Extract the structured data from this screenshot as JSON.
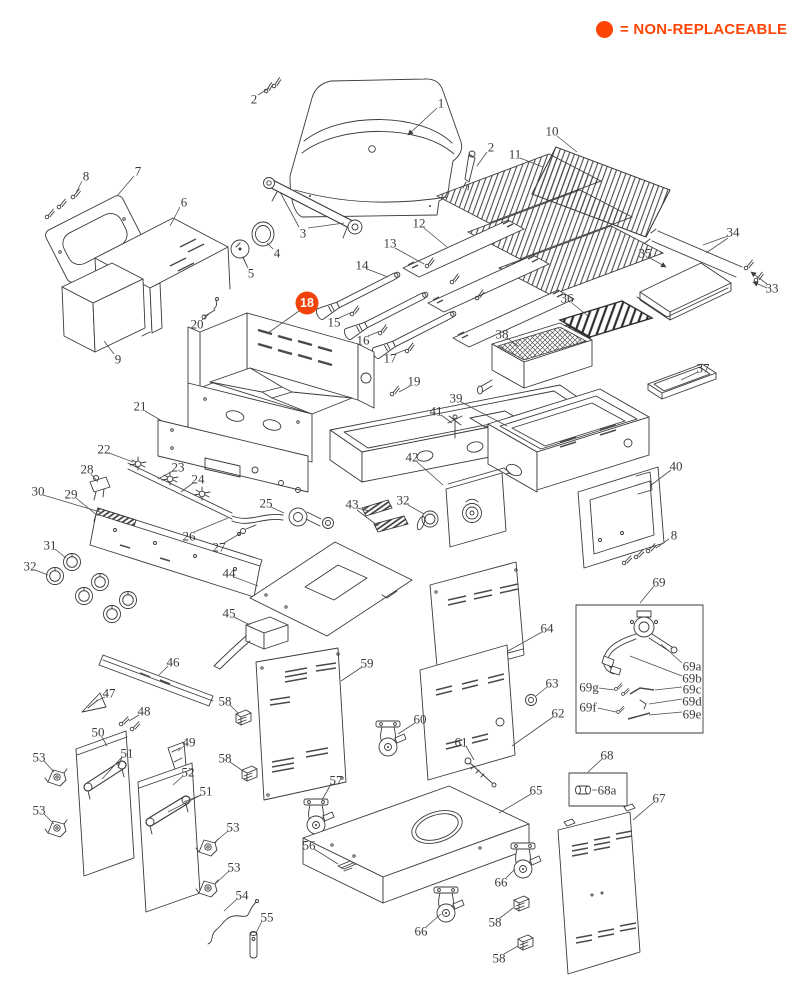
{
  "legend": {
    "text": "= NON-REPLACEABLE",
    "color": "#ff4505"
  },
  "highlight": {
    "part": "18",
    "color": "#f2430b",
    "text_color": "#ffffff"
  },
  "diagram": {
    "labels": [
      {
        "t": "1",
        "x": 441,
        "y": 103,
        "arrow": true,
        "leaders": [
          [
            437,
            108,
            408,
            135
          ]
        ]
      },
      {
        "t": "2",
        "x": 254,
        "y": 99,
        "leaders": [
          [
            258,
            95,
            269,
            88
          ]
        ]
      },
      {
        "t": "2",
        "x": 491,
        "y": 147,
        "leaders": [
          [
            487,
            152,
            477,
            166
          ]
        ]
      },
      {
        "t": "3",
        "x": 303,
        "y": 233,
        "leaders": [
          [
            299,
            227,
            280,
            192
          ],
          [
            308,
            228,
            344,
            223
          ]
        ]
      },
      {
        "t": "4",
        "x": 277,
        "y": 253,
        "leaders": [
          [
            273,
            249,
            267,
            243
          ]
        ]
      },
      {
        "t": "5",
        "x": 251,
        "y": 273,
        "leaders": [
          [
            248,
            268,
            243,
            258
          ]
        ]
      },
      {
        "t": "6",
        "x": 184,
        "y": 202,
        "leaders": [
          [
            180,
            207,
            170,
            226
          ]
        ]
      },
      {
        "t": "7",
        "x": 138,
        "y": 171,
        "leaders": [
          [
            134,
            176,
            117,
            196
          ]
        ]
      },
      {
        "t": "8",
        "x": 86,
        "y": 176,
        "leaders": [
          [
            82,
            181,
            76,
            193
          ]
        ]
      },
      {
        "t": "8",
        "x": 674,
        "y": 535,
        "leaders": [
          [
            669,
            539,
            656,
            548
          ]
        ]
      },
      {
        "t": "9",
        "x": 118,
        "y": 359,
        "leaders": [
          [
            114,
            354,
            104,
            341
          ]
        ]
      },
      {
        "t": "10",
        "x": 552,
        "y": 131,
        "leaders": [
          [
            557,
            136,
            577,
            152
          ]
        ]
      },
      {
        "t": "11",
        "x": 515,
        "y": 154,
        "leaders": [
          [
            520,
            158,
            543,
            167
          ]
        ]
      },
      {
        "t": "12",
        "x": 419,
        "y": 223,
        "leaders": [
          [
            424,
            228,
            447,
            247
          ]
        ]
      },
      {
        "t": "13",
        "x": 390,
        "y": 243,
        "leaders": [
          [
            395,
            248,
            424,
            264
          ]
        ]
      },
      {
        "t": "14",
        "x": 362,
        "y": 265,
        "leaders": [
          [
            367,
            269,
            388,
            277
          ]
        ]
      },
      {
        "t": "15",
        "x": 334,
        "y": 322,
        "leaders": [
          [
            339,
            318,
            350,
            313
          ]
        ]
      },
      {
        "t": "16",
        "x": 363,
        "y": 340,
        "leaders": [
          [
            368,
            336,
            378,
            332
          ]
        ]
      },
      {
        "t": "17",
        "x": 390,
        "y": 358,
        "leaders": [
          [
            395,
            354,
            405,
            350
          ]
        ]
      },
      {
        "t": "18",
        "x": 307,
        "y": 303,
        "badge": true,
        "leaders": [
          [
            299,
            311,
            268,
            333
          ]
        ]
      },
      {
        "t": "19",
        "x": 414,
        "y": 381,
        "leaders": [
          [
            410,
            386,
            399,
            392
          ]
        ]
      },
      {
        "t": "20",
        "x": 197,
        "y": 324,
        "leaders": [
          [
            202,
            320,
            209,
            314
          ]
        ]
      },
      {
        "t": "21",
        "x": 140,
        "y": 406,
        "leaders": [
          [
            145,
            411,
            162,
            421
          ]
        ]
      },
      {
        "t": "22",
        "x": 104,
        "y": 449,
        "leaders": [
          [
            109,
            453,
            133,
            462
          ]
        ]
      },
      {
        "t": "23",
        "x": 178,
        "y": 467,
        "leaders": [
          [
            173,
            471,
            158,
            479
          ]
        ]
      },
      {
        "t": "24",
        "x": 198,
        "y": 479,
        "leaders": [
          [
            193,
            483,
            181,
            492
          ]
        ]
      },
      {
        "t": "25",
        "x": 266,
        "y": 503,
        "leaders": [
          [
            271,
            507,
            284,
            513
          ]
        ]
      },
      {
        "t": "26",
        "x": 189,
        "y": 536,
        "leaders": [
          [
            194,
            532,
            228,
            518
          ]
        ]
      },
      {
        "t": "27",
        "x": 219,
        "y": 547,
        "leaders": [
          [
            224,
            543,
            241,
            533
          ]
        ]
      },
      {
        "t": "28",
        "x": 87,
        "y": 469,
        "leaders": [
          [
            91,
            474,
            98,
            482
          ]
        ]
      },
      {
        "t": "29",
        "x": 71,
        "y": 494,
        "leaders": [
          [
            76,
            498,
            98,
            516
          ]
        ]
      },
      {
        "t": "30",
        "x": 38,
        "y": 491,
        "leaders": [
          [
            43,
            495,
            100,
            512
          ]
        ]
      },
      {
        "t": "31",
        "x": 50,
        "y": 545,
        "leaders": [
          [
            55,
            549,
            66,
            558
          ]
        ]
      },
      {
        "t": "32",
        "x": 30,
        "y": 566,
        "leaders": [
          [
            35,
            570,
            48,
            575
          ]
        ]
      },
      {
        "t": "32",
        "x": 403,
        "y": 500,
        "leaders": [
          [
            408,
            505,
            424,
            514
          ]
        ]
      },
      {
        "t": "33",
        "x": 772,
        "y": 288,
        "arrow": true,
        "leaders": [
          [
            767,
            284,
            751,
            272
          ],
          [
            767,
            288,
            753,
            282
          ]
        ]
      },
      {
        "t": "34",
        "x": 733,
        "y": 232,
        "leaders": [
          [
            728,
            236,
            703,
            245
          ],
          [
            728,
            238,
            706,
            253
          ]
        ]
      },
      {
        "t": "35",
        "x": 645,
        "y": 253,
        "arrow": true,
        "leaders": [
          [
            650,
            258,
            666,
            267
          ]
        ]
      },
      {
        "t": "36",
        "x": 567,
        "y": 298,
        "leaders": [
          [
            572,
            303,
            588,
            316
          ]
        ]
      },
      {
        "t": "37",
        "x": 703,
        "y": 368,
        "leaders": [
          [
            698,
            372,
            681,
            380
          ]
        ]
      },
      {
        "t": "38",
        "x": 502,
        "y": 334,
        "leaders": [
          [
            507,
            338,
            518,
            346
          ]
        ]
      },
      {
        "t": "39",
        "x": 456,
        "y": 398,
        "leaders": [
          [
            461,
            402,
            507,
            426
          ]
        ]
      },
      {
        "t": "40",
        "x": 676,
        "y": 466,
        "leaders": [
          [
            671,
            470,
            650,
            486
          ]
        ]
      },
      {
        "t": "41",
        "x": 436,
        "y": 411,
        "leaders": [
          [
            441,
            415,
            452,
            423
          ]
        ]
      },
      {
        "t": "42",
        "x": 412,
        "y": 457,
        "leaders": [
          [
            417,
            462,
            443,
            485
          ]
        ]
      },
      {
        "t": "43",
        "x": 352,
        "y": 504,
        "leaders": [
          [
            357,
            508,
            369,
            511
          ],
          [
            357,
            510,
            378,
            526
          ]
        ]
      },
      {
        "t": "44",
        "x": 229,
        "y": 573,
        "leaders": [
          [
            234,
            577,
            258,
            586
          ]
        ]
      },
      {
        "t": "45",
        "x": 229,
        "y": 613,
        "leaders": [
          [
            234,
            617,
            250,
            625
          ]
        ]
      },
      {
        "t": "46",
        "x": 173,
        "y": 662,
        "leaders": [
          [
            168,
            666,
            159,
            675
          ]
        ]
      },
      {
        "t": "47",
        "x": 109,
        "y": 693,
        "leaders": [
          [
            105,
            697,
            96,
            701
          ]
        ]
      },
      {
        "t": "48",
        "x": 144,
        "y": 711,
        "leaders": [
          [
            139,
            715,
            129,
            721
          ]
        ]
      },
      {
        "t": "49",
        "x": 189,
        "y": 742,
        "leaders": [
          [
            184,
            746,
            178,
            751
          ]
        ]
      },
      {
        "t": "50",
        "x": 98,
        "y": 732,
        "leaders": [
          [
            102,
            737,
            107,
            746
          ]
        ]
      },
      {
        "t": "51",
        "x": 127,
        "y": 753,
        "leaders": [
          [
            122,
            757,
            102,
            779
          ],
          [
            122,
            757,
            118,
            768
          ]
        ]
      },
      {
        "t": "51",
        "x": 206,
        "y": 791,
        "leaders": [
          [
            201,
            795,
            168,
            812
          ],
          [
            201,
            795,
            184,
            802
          ]
        ]
      },
      {
        "t": "52",
        "x": 188,
        "y": 772,
        "leaders": [
          [
            183,
            776,
            173,
            785
          ]
        ]
      },
      {
        "t": "53",
        "x": 39,
        "y": 757,
        "leaders": [
          [
            44,
            761,
            54,
            772
          ]
        ]
      },
      {
        "t": "53",
        "x": 39,
        "y": 810,
        "leaders": [
          [
            44,
            814,
            54,
            824
          ]
        ]
      },
      {
        "t": "53",
        "x": 233,
        "y": 827,
        "leaders": [
          [
            228,
            831,
            214,
            843
          ]
        ]
      },
      {
        "t": "53",
        "x": 234,
        "y": 867,
        "leaders": [
          [
            229,
            871,
            215,
            884
          ]
        ]
      },
      {
        "t": "54",
        "x": 242,
        "y": 895,
        "leaders": [
          [
            237,
            899,
            224,
            911
          ]
        ]
      },
      {
        "t": "55",
        "x": 267,
        "y": 917,
        "leaders": [
          [
            262,
            921,
            256,
            933
          ]
        ]
      },
      {
        "t": "56",
        "x": 309,
        "y": 845,
        "leaders": [
          [
            314,
            849,
            338,
            864
          ]
        ]
      },
      {
        "t": "57",
        "x": 336,
        "y": 780,
        "leaders": [
          [
            331,
            784,
            322,
            800
          ]
        ]
      },
      {
        "t": "58",
        "x": 225,
        "y": 701,
        "leaders": [
          [
            230,
            705,
            239,
            714
          ]
        ]
      },
      {
        "t": "58",
        "x": 225,
        "y": 758,
        "leaders": [
          [
            230,
            762,
            243,
            771
          ]
        ]
      },
      {
        "t": "58",
        "x": 495,
        "y": 922,
        "leaders": [
          [
            500,
            918,
            513,
            908
          ]
        ]
      },
      {
        "t": "58",
        "x": 499,
        "y": 958,
        "leaders": [
          [
            504,
            954,
            518,
            946
          ]
        ]
      },
      {
        "t": "59",
        "x": 367,
        "y": 663,
        "leaders": [
          [
            362,
            667,
            341,
            681
          ]
        ]
      },
      {
        "t": "60",
        "x": 420,
        "y": 719,
        "leaders": [
          [
            415,
            723,
            398,
            734
          ]
        ]
      },
      {
        "t": "61",
        "x": 461,
        "y": 742,
        "leaders": [
          [
            466,
            746,
            474,
            760
          ]
        ]
      },
      {
        "t": "62",
        "x": 558,
        "y": 713,
        "leaders": [
          [
            553,
            717,
            512,
            746
          ]
        ]
      },
      {
        "t": "63",
        "x": 552,
        "y": 683,
        "leaders": [
          [
            547,
            687,
            536,
            696
          ]
        ]
      },
      {
        "t": "64",
        "x": 547,
        "y": 628,
        "leaders": [
          [
            542,
            632,
            508,
            651
          ]
        ]
      },
      {
        "t": "65",
        "x": 536,
        "y": 790,
        "leaders": [
          [
            531,
            794,
            499,
            813
          ]
        ]
      },
      {
        "t": "66",
        "x": 501,
        "y": 882,
        "leaders": [
          [
            506,
            878,
            515,
            869
          ]
        ]
      },
      {
        "t": "66",
        "x": 421,
        "y": 931,
        "leaders": [
          [
            426,
            927,
            441,
            914
          ]
        ]
      },
      {
        "t": "67",
        "x": 659,
        "y": 798,
        "leaders": [
          [
            654,
            802,
            633,
            820
          ]
        ]
      },
      {
        "t": "68",
        "x": 607,
        "y": 755,
        "leaders": [
          [
            602,
            759,
            588,
            772
          ]
        ]
      },
      {
        "t": "68a",
        "x": 607,
        "y": 790,
        "leaders": [
          [
            597,
            790,
            592,
            790
          ]
        ]
      },
      {
        "t": "69",
        "x": 659,
        "y": 582,
        "leaders": [
          [
            654,
            586,
            640,
            603
          ]
        ]
      },
      {
        "t": "69a",
        "x": 692,
        "y": 666,
        "leaders": [
          [
            682,
            663,
            661,
            644
          ]
        ]
      },
      {
        "t": "69b",
        "x": 692,
        "y": 678,
        "leaders": [
          [
            682,
            676,
            630,
            656
          ]
        ]
      },
      {
        "t": "69c",
        "x": 692,
        "y": 689,
        "leaders": [
          [
            682,
            687,
            655,
            690
          ]
        ]
      },
      {
        "t": "69d",
        "x": 692,
        "y": 701,
        "leaders": [
          [
            682,
            699,
            649,
            704
          ]
        ]
      },
      {
        "t": "69e",
        "x": 692,
        "y": 714,
        "leaders": [
          [
            682,
            712,
            649,
            715
          ]
        ]
      },
      {
        "t": "69g",
        "x": 589,
        "y": 687,
        "leaders": [
          [
            599,
            688,
            614,
            690
          ]
        ]
      },
      {
        "t": "69f",
        "x": 588,
        "y": 707,
        "leaders": [
          [
            598,
            708,
            616,
            712
          ]
        ]
      }
    ]
  }
}
